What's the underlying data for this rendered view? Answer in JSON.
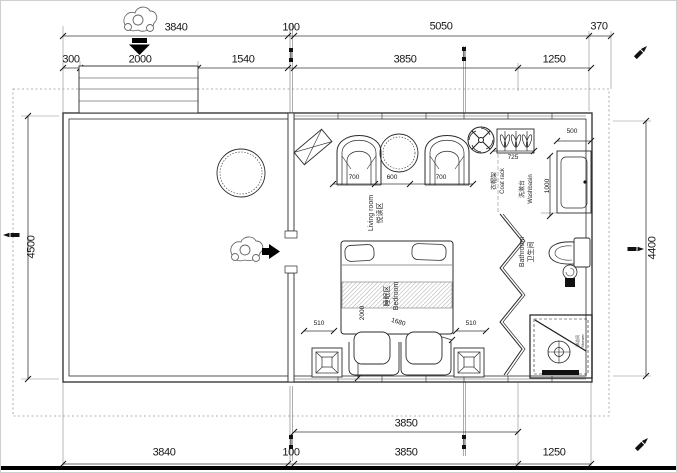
{
  "dims": {
    "top_row1": [
      "3840",
      "100",
      "5050",
      "370"
    ],
    "top_row2": [
      "300",
      "2000",
      "1540",
      "3850",
      "1250"
    ],
    "bottom_row1": [
      "3850"
    ],
    "bottom_row2": [
      "3840",
      "100",
      "3850",
      "1250"
    ],
    "left_height": "4500",
    "right_height": "4400",
    "living_widths": [
      "700",
      "600",
      "700"
    ],
    "coat_rack_width": "725",
    "washbasin_width": "500",
    "washbasin_depth": "1000",
    "bed_length": "2000",
    "bed_diagonal": "1680",
    "bed_side_left": "510",
    "bed_side_right": "510"
  },
  "labels": {
    "living_en": "Living room",
    "living_zh": "悦读区",
    "bedroom_en": "Bedroom",
    "bedroom_zh": "睡眠区",
    "bathroom_en": "Bathroom",
    "bathroom_zh": "卫生间",
    "washbasin_en": "Washbasin",
    "washbasin_zh": "洗漱台",
    "coatrack_en": "Coat rack",
    "coatrack_zh": "衣帽架",
    "shower_en": "Shower",
    "shower_zh": "淋浴间"
  },
  "icons": {
    "entry_person": "person-top-view",
    "entry_direction": "thick-down-arrow",
    "deck_person": "person-top-view",
    "deck_direction": "thick-right-arrow",
    "ceiling_fan": "fan-cross-circle",
    "edge_markers": "pen-marker"
  },
  "colors": {
    "line": "#2b2b2b",
    "dim": "#1f1f1f",
    "boundary": "#999999",
    "solid": "#111111",
    "bg": "#ffffff"
  }
}
